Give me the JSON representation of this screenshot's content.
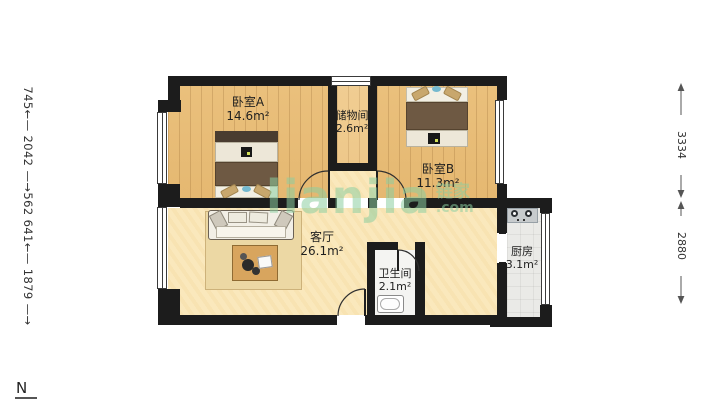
{
  "plan": {
    "compass": "N",
    "watermark": {
      "brand": "lianjia",
      "cjk": "链家",
      "tld": ".com"
    },
    "rooms": [
      {
        "name": "卧室A",
        "area": "14.6m²"
      },
      {
        "name": "储物间",
        "area": "2.6m²"
      },
      {
        "name": "卧室B",
        "area": "11.3m²"
      },
      {
        "name": "客厅",
        "area": "26.1m²"
      },
      {
        "name": "卫生间",
        "area": "2.1m²"
      },
      {
        "name": "厨房",
        "area": "3.1m²"
      }
    ],
    "dimensions": {
      "left_chain_display": "745←— 2042 —→562 641←— 1879 —→",
      "left_chain": [
        "745",
        "2042",
        "562",
        "641",
        "1879"
      ],
      "right": [
        "3334",
        "2880"
      ]
    },
    "colors": {
      "wall": "#1c1c1c",
      "wood_floor": "#e9c07c",
      "living_floor": "#fae8bc",
      "kitchen_floor": "#eaeae7",
      "bath_floor": "#f4f4f2",
      "watermark_green": "#9cd4ad"
    }
  }
}
